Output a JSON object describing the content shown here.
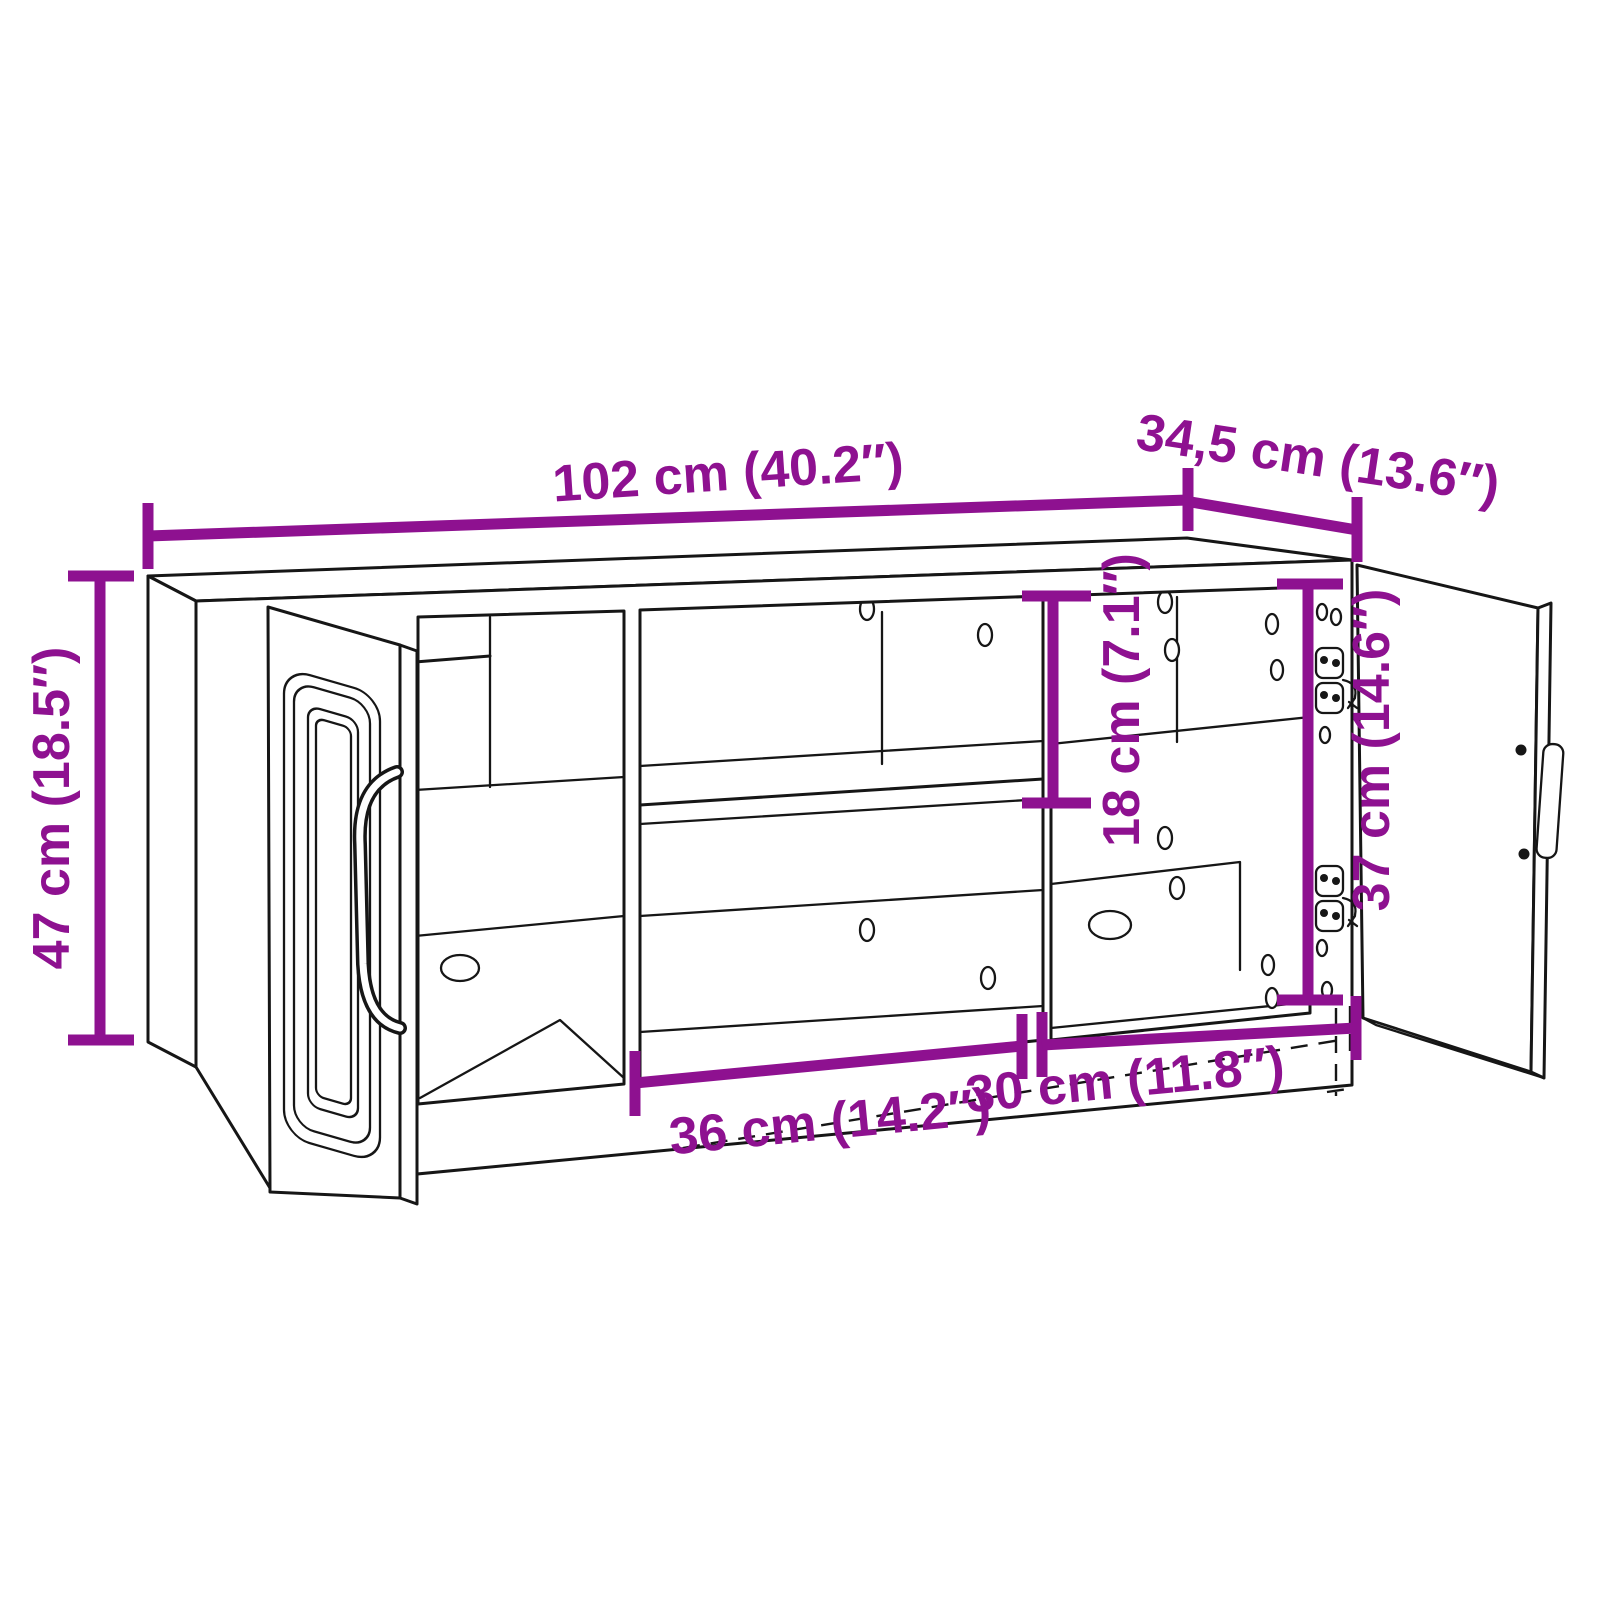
{
  "page": {
    "background": "#ffffff"
  },
  "diagram": {
    "kind": "furniture-dimension-line-drawing",
    "subject": "TV cabinet with glass door, open shelf compartments and hinged right door",
    "colors": {
      "dimension_annotation": "#8e1190",
      "line_art": "#161616",
      "background": "#ffffff"
    },
    "dimensions": {
      "width": {
        "label": "102 cm (40.2″)"
      },
      "depth": {
        "label": "34,5 cm (13.6″)"
      },
      "height": {
        "label": "47 cm (18.5″)"
      },
      "upper_opening_height": {
        "label": "18 cm (7.1″)"
      },
      "door_opening_height": {
        "label": "37 cm (14.6″)"
      },
      "middle_opening_width": {
        "label": "36 cm (14.2″)"
      },
      "right_opening_width": {
        "label": "30 cm (11.8″)"
      }
    }
  }
}
